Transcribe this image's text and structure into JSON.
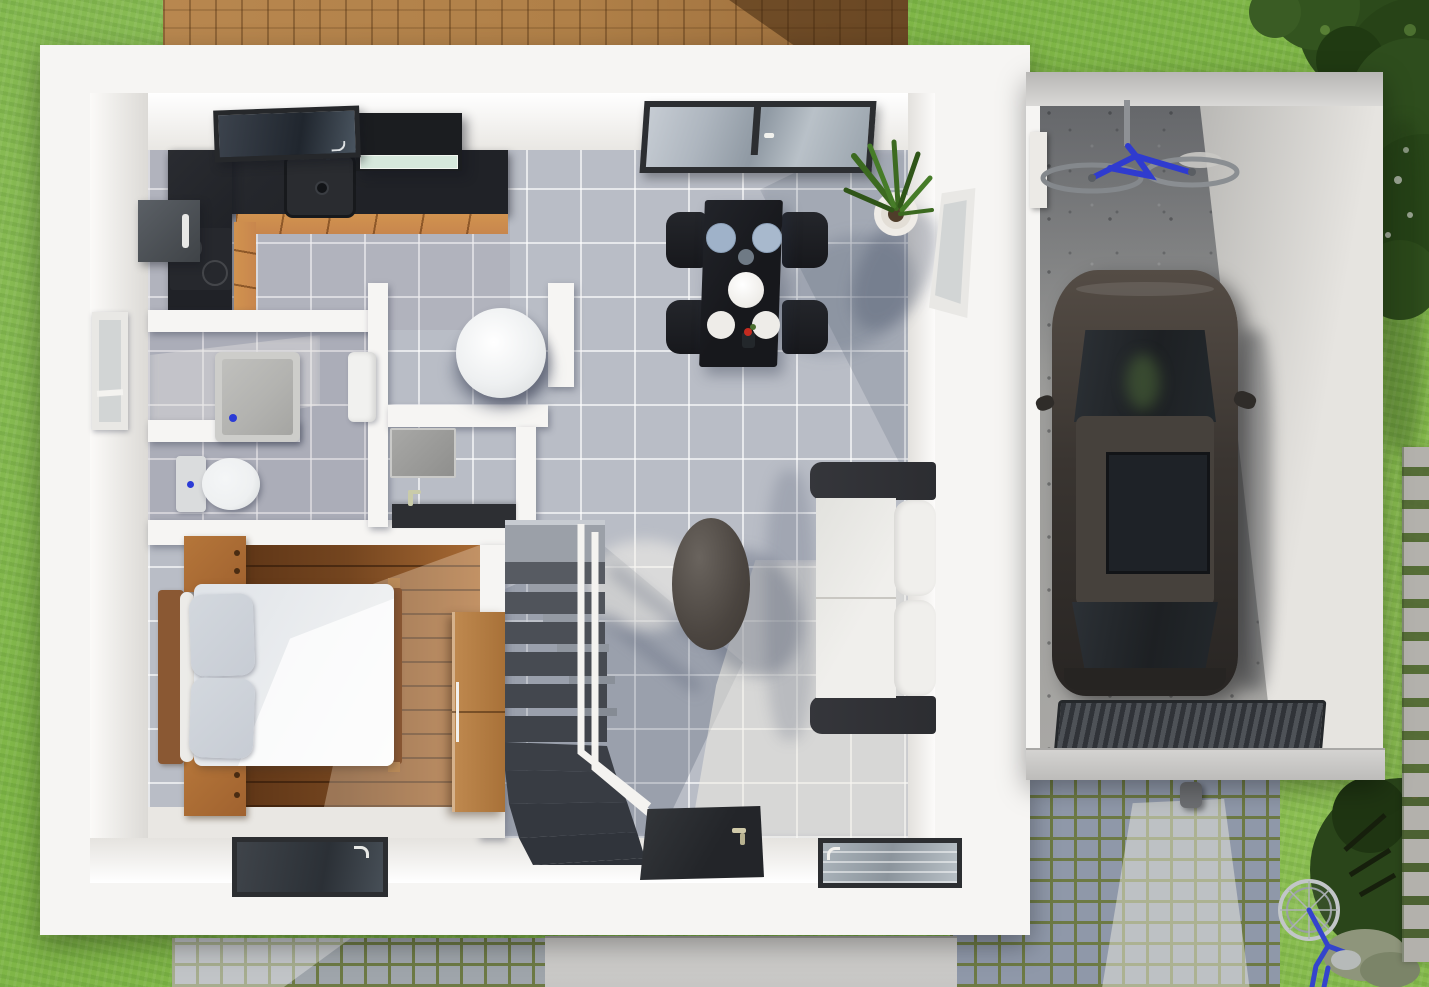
{
  "scene": {
    "label": "Top-down 3D rendering of a small modern house floor plan with attached garage, lawn, wooden deck and cobblestone driveway",
    "floor_label": "ground floor"
  },
  "colors": {
    "grass": "#7fb647",
    "grassLight": "#95c857",
    "grassShade": "#4f7e2d",
    "deck": "#b08048",
    "deckShadow": "#6e4a28",
    "wall": "#f6f5f3",
    "wallShade": "#e0ded9",
    "tile": "#b9bdc6",
    "tileShadow": "rgba(66,76,100,0.26)",
    "tileLight": "rgba(240,236,227,0.55)",
    "counter": "#202227",
    "cabinet": "#c8864d",
    "bedroomWood": "#74451f",
    "bedroomWoodLight": "#a86a33",
    "stairTread": "#4b4f57",
    "rail": "#f4f3f0",
    "sofaFrame": "#2c2d31",
    "cushion": "#f0efec",
    "diningTable": "#17181c",
    "plate": "#eeece8",
    "plateShaded": "#9fb2c9",
    "furnitureOak": "#a0622f",
    "wardrobe": "#c08a50",
    "duvet": "#eceef0",
    "pillow": "#c7ccd4",
    "headboard": "#8a5833",
    "showerTray": "#b3b3b0",
    "fixture": "#eef0f1",
    "concrete": "#9c9c9a",
    "carBody": "#3a3531",
    "carGlass": "#1d2023",
    "carRoof": "#46413c",
    "cobble": "#8f98a9",
    "cobbleLight": "#c9c9c6",
    "cobbleJoint": "#6d7a45",
    "slab": "#c6c5c3",
    "doorDark": "#2b2d30",
    "frame": "#2c2e31",
    "glass": "#aab3bc",
    "glassDark": "#3c434d",
    "hood": "#1b1d20",
    "hoodLight": "#d6e8dc",
    "plantGreen": "#3c6a20",
    "treeGreen": "#2c4a1b",
    "treeDark": "#203a12",
    "bikeBlue": "#2f3bcf",
    "steel": "#8e9195",
    "pot": "#efece7",
    "appliance": "#4d5258"
  },
  "outdoor": {
    "lawn": "grass lawn",
    "deck": "wooden terrace deck",
    "trees": "trees and shrubs",
    "stepping_stones": "stepping stone path",
    "driveway": "cobblestone driveway",
    "front_path": "concrete walkway",
    "curb_cobbles": "cobblestone strip",
    "bicycle": "blue bicycle on lawn"
  },
  "house": {
    "label": "house, ground floor",
    "kitchen": {
      "label": "kitchen",
      "countertop": "black L-shaped countertop",
      "sink": "kitchen sink",
      "cooktop": "cooktop",
      "hood": "range hood",
      "refrigerator": "refrigerator",
      "cabinets": "wooden base cabinets",
      "skylight": "roof window"
    },
    "dining_area": {
      "label": "dining area",
      "table": "black dining table",
      "chairs": [
        "chair",
        "chair",
        "chair",
        "chair"
      ],
      "tableware": [
        "plate",
        "plate",
        "small bowl",
        "serving bowl",
        "plate",
        "plate",
        "flower vase"
      ],
      "plant": "potted plant",
      "patio_door": "sliding glass door"
    },
    "living_area": {
      "label": "living area",
      "sofa": "two-seat sofa with white cushions",
      "coffee_table": "oval coffee table",
      "window": "side window"
    },
    "bathroom": {
      "label": "bathroom",
      "shower": "shower tray",
      "toilet": "toilet",
      "washbasin": "washbasin",
      "window": "bathroom window"
    },
    "wc": {
      "label": "toilet room",
      "basin": "round washbasin"
    },
    "utility": {
      "label": "utility room",
      "door": "door leaf",
      "counter": "counter with faucet"
    },
    "bedroom": {
      "label": "bedroom",
      "bed": "double bed with white duvet",
      "pillows": [
        "pillow",
        "pillow"
      ],
      "headboard": "wooden headboard",
      "nightstands": [
        "nightstand",
        "nightstand"
      ],
      "wardrobe": "wooden wardrobe",
      "window": "bedroom window",
      "floor": "dark wood flooring"
    },
    "hall": {
      "label": "entrance hall",
      "stairs": "winder staircase",
      "railing": "white handrail",
      "front_door": "front door",
      "window": "hall window"
    }
  },
  "garage": {
    "label": "garage",
    "car": "dark sedan car",
    "bicycle": "bicycle hanging from ceiling mount",
    "floor": "concrete floor",
    "drain": "drainage grate",
    "threshold": "garage door threshold",
    "cabinet": "wall cabinet"
  }
}
